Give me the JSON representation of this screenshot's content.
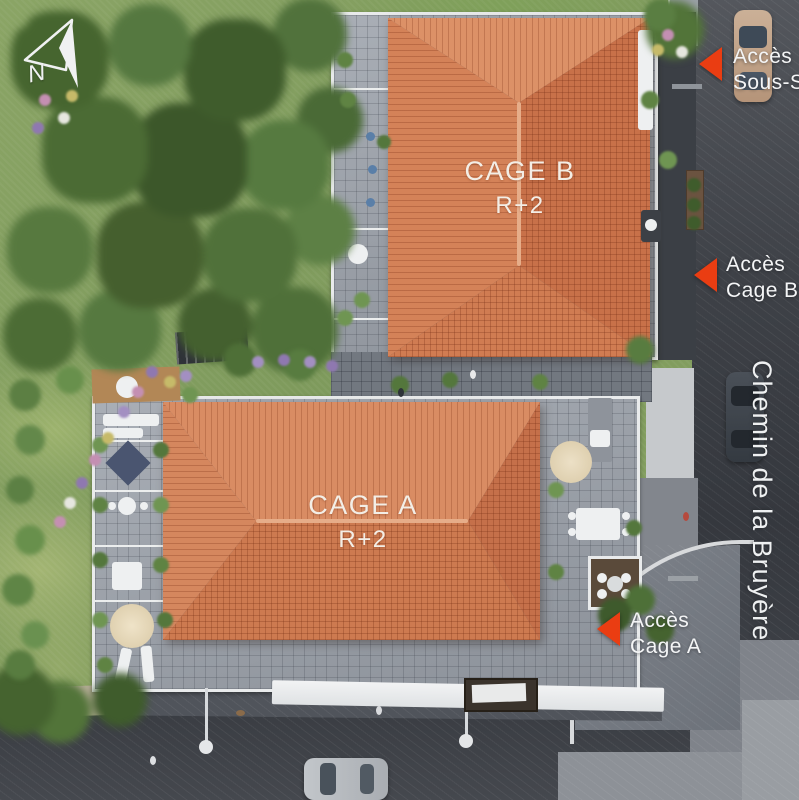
{
  "compass": {
    "label": "N"
  },
  "buildings": {
    "cage_b": {
      "name": "CAGE B",
      "level": "R+2"
    },
    "cage_a": {
      "name": "CAGE A",
      "level": "R+2"
    }
  },
  "access": {
    "sous_sol": {
      "line1": "Accès",
      "line2": "Sous-Sol"
    },
    "cage_b": {
      "line1": "Accès",
      "line2": "Cage B"
    },
    "cage_a": {
      "line1": "Accès",
      "line2": "Cage A"
    }
  },
  "street": {
    "name": "Chemin de la Bruyère"
  },
  "colors": {
    "accent_arrow_red": "#ea3d12",
    "roof_terracotta": "#d08057",
    "label_white": "#f4f5f6",
    "asphalt": "#3e4147",
    "lawn_green": "#87a263"
  }
}
